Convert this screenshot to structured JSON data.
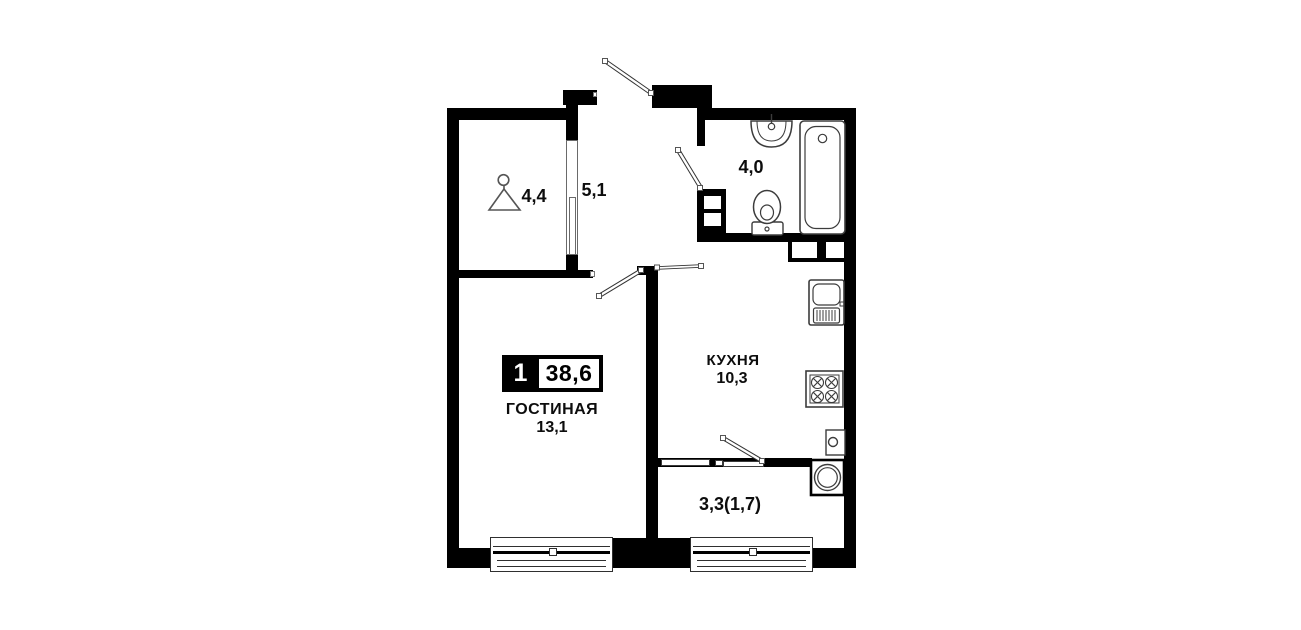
{
  "plan": {
    "badge": {
      "rooms": "1",
      "area": "38,6"
    },
    "rooms": {
      "wardrobe": {
        "area": "4,4"
      },
      "hallway": {
        "area": "5,1"
      },
      "bathroom": {
        "area": "4,0"
      },
      "kitchen": {
        "name": "КУХНЯ",
        "area": "10,3"
      },
      "living": {
        "name": "ГОСТИНАЯ",
        "area": "13,1"
      },
      "balcony": {
        "area": "3,3(1,7)"
      }
    },
    "colors": {
      "wall": "#000000",
      "fixture_stroke": "#3c3c3c",
      "background": "#ffffff"
    },
    "icons": [
      "hanger-icon",
      "bathroom-sink",
      "bathtub",
      "toilet",
      "kitchen-sink",
      "stove",
      "washing-machine",
      "water-heater",
      "entrance-door",
      "bathroom-door",
      "living-room-door",
      "balcony-door"
    ]
  }
}
